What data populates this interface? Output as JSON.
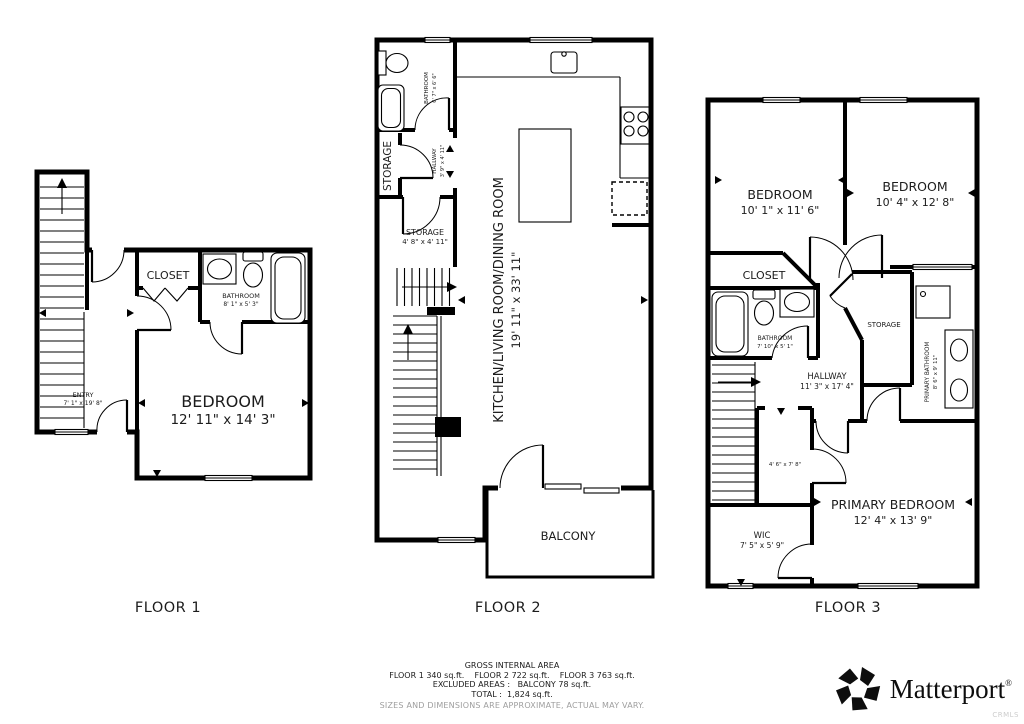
{
  "floors": [
    {
      "label": "FLOOR 1",
      "rooms": {
        "entry": {
          "name": "ENTRY",
          "dims": "7' 1\" x 19' 8\""
        },
        "closet": {
          "name": "CLOSET"
        },
        "bathroom": {
          "name": "BATHROOM",
          "dims": "8' 1\" x 5' 3\""
        },
        "bedroom": {
          "name": "BEDROOM",
          "dims": "12' 11\" x 14' 3\""
        }
      }
    },
    {
      "label": "FLOOR 2",
      "rooms": {
        "bathroom": {
          "name": "BATHROOM",
          "dims": "6' 7\" x 6' 6\""
        },
        "storage_upper": {
          "name": "STORAGE"
        },
        "hallway": {
          "name": "HALLWAY",
          "dims": "3' 9\" x 4' 11\""
        },
        "storage_lower": {
          "name": "STORAGE",
          "dims": "4' 8\" x 4' 11\""
        },
        "main": {
          "name": "KITCHEN/LIVING ROOM/DINING ROOM",
          "dims": "19' 11\" x 33' 11\""
        },
        "balcony": {
          "name": "BALCONY"
        }
      }
    },
    {
      "label": "FLOOR 3",
      "rooms": {
        "bedroom_left": {
          "name": "BEDROOM",
          "dims": "10' 1\" x 11' 6\""
        },
        "bedroom_right": {
          "name": "BEDROOM",
          "dims": "10' 4\" x 12' 8\""
        },
        "closet": {
          "name": "CLOSET"
        },
        "bathroom": {
          "name": "BATHROOM",
          "dims": "7' 10\" x 5' 1\""
        },
        "storage": {
          "name": "STORAGE"
        },
        "primary_bathroom": {
          "name": "PRIMARY BATHROOM",
          "dims": "8' 6\" x 9' 11\""
        },
        "hallway": {
          "name": "HALLWAY",
          "dims": "11' 3\" x 17' 4\""
        },
        "closet_small": {
          "dims": "4' 6\" x 7' 8\""
        },
        "wic": {
          "name": "WIC",
          "dims": "7' 5\" x 5' 9\""
        },
        "primary_bedroom": {
          "name": "PRIMARY BEDROOM",
          "dims": "12' 4\" x 13' 9\""
        }
      }
    }
  ],
  "footer": {
    "title": "GROSS INTERNAL AREA",
    "floors_line": "FLOOR 1 340 sq.ft.    FLOOR 2 722 sq.ft.    FLOOR 3 763 sq.ft.",
    "excluded_line": "EXCLUDED AREAS :   BALCONY 78 sq.ft.",
    "total_line": "TOTAL :  1,824 sq.ft.",
    "disclaimer": "SIZES AND DIMENSIONS ARE APPROXIMATE, ACTUAL MAY VARY."
  },
  "branding": {
    "logo_text": "Matterport",
    "trademark": "®",
    "watermark": "CRMLS"
  },
  "colors": {
    "wall": "#000000",
    "text": "#1c1c1c",
    "disclaimer": "#9e9e9e",
    "watermark": "#cccccc"
  }
}
